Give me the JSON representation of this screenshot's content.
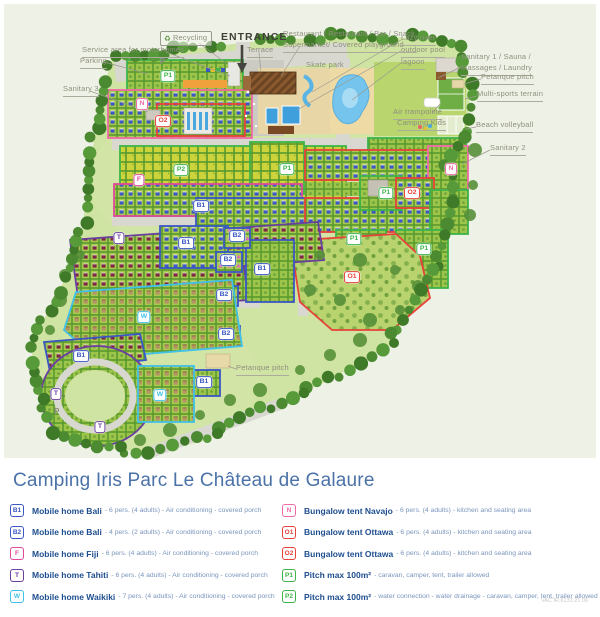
{
  "title": "Camping Iris Parc Le Château de Galaure",
  "note": "VAC IR.6133.21 06",
  "map": {
    "colors": {
      "blue": "#3a57c4",
      "magenta": "#e0489b",
      "purple": "#6a3fa0",
      "cyan": "#3fc1e8",
      "pink": "#f06aa8",
      "red": "#e8423a",
      "green": "#3db54a"
    },
    "labels": [
      {
        "t": "Recycling",
        "x": 160,
        "y": 31,
        "cls": "boxed",
        "icon": "recycle",
        "line": [
          199,
          43,
          226,
          63
        ]
      },
      {
        "t": "ENTRANCE",
        "x": 221,
        "y": 30,
        "cls": "entrance"
      },
      {
        "t": "Service area for motorhomes",
        "x": 82,
        "y": 45,
        "ul": 1,
        "line": [
          166,
          52,
          230,
          76
        ]
      },
      {
        "t": "Parking",
        "x": 80,
        "y": 56,
        "ul": 1,
        "line": [
          104,
          62,
          148,
          74
        ]
      },
      {
        "t": "Sanitary 3",
        "x": 63,
        "y": 84,
        "ul": 1,
        "line": [
          90,
          91,
          148,
          112
        ]
      },
      {
        "t": "Terrace",
        "x": 247,
        "y": 45,
        "ul": 1,
        "line": [
          259,
          52,
          261,
          72
        ]
      },
      {
        "t": "Restaurant / Restaurant / Bar / Snack,\nSupermarket/ Covered playground",
        "x": 283,
        "y": 29,
        "ul": 1,
        "line": [
          300,
          46,
          281,
          76
        ]
      },
      {
        "t": "Lazy river",
        "x": 401,
        "y": 33,
        "ul": 1,
        "line": [
          401,
          40,
          312,
          92
        ]
      },
      {
        "t": "outdoor pool",
        "x": 401,
        "y": 45,
        "ul": 1,
        "line": [
          401,
          51,
          297,
          110
        ]
      },
      {
        "t": "lagoon",
        "x": 401,
        "y": 57,
        "ul": 1,
        "line": [
          401,
          63,
          352,
          100
        ]
      },
      {
        "t": "Skate park",
        "x": 306,
        "y": 60
      },
      {
        "t": "Sanitary 1 / Sauna /\nMassages / Laundry",
        "x": 461,
        "y": 52,
        "ul": 1,
        "line": [
          461,
          67,
          438,
          78
        ]
      },
      {
        "t": "Petanque pitch",
        "x": 481,
        "y": 72,
        "ul": 1,
        "line": [
          481,
          79,
          464,
          84
        ]
      },
      {
        "t": "Multi-sports terrain",
        "x": 477,
        "y": 89,
        "ul": 1,
        "line": [
          477,
          96,
          465,
          99
        ]
      },
      {
        "t": "Air trampoline",
        "x": 393,
        "y": 107,
        "ul": 1,
        "line": [
          432,
          113,
          440,
          104
        ]
      },
      {
        "t": "Camping Kids",
        "x": 397,
        "y": 118,
        "ul": 1,
        "line": [
          424,
          125,
          423,
          129
        ]
      },
      {
        "t": "Beach volleyball",
        "x": 476,
        "y": 120,
        "ul": 1,
        "line": [
          476,
          127,
          466,
          129
        ]
      },
      {
        "t": "Sanitary 2",
        "x": 490,
        "y": 143,
        "ul": 1,
        "line": [
          490,
          150,
          462,
          164
        ]
      },
      {
        "t": "Petanque pitch",
        "x": 236,
        "y": 363,
        "ul": 1,
        "line": [
          236,
          369,
          228,
          366
        ]
      },
      {
        "t": "P",
        "x": 160,
        "y": 56,
        "cls": "roadmark"
      },
      {
        "t": "P",
        "x": 54,
        "y": 406,
        "cls": "roadmark"
      }
    ],
    "badges": [
      {
        "l": "P1",
        "x": 168,
        "y": 76,
        "c": "green"
      },
      {
        "l": "N",
        "x": 142,
        "y": 104,
        "c": "pink"
      },
      {
        "l": "O2",
        "x": 163,
        "y": 121,
        "c": "red"
      },
      {
        "l": "P2",
        "x": 181,
        "y": 170,
        "c": "green"
      },
      {
        "l": "F",
        "x": 139,
        "y": 180,
        "c": "magenta"
      },
      {
        "l": "P1",
        "x": 287,
        "y": 169,
        "c": "green"
      },
      {
        "l": "B1",
        "x": 201,
        "y": 206,
        "c": "blue"
      },
      {
        "l": "N",
        "x": 451,
        "y": 169,
        "c": "pink"
      },
      {
        "l": "P1",
        "x": 386,
        "y": 193,
        "c": "green"
      },
      {
        "l": "O2",
        "x": 412,
        "y": 193,
        "c": "red"
      },
      {
        "l": "T",
        "x": 119,
        "y": 238,
        "c": "purple"
      },
      {
        "l": "B2",
        "x": 237,
        "y": 236,
        "c": "blue"
      },
      {
        "l": "B1",
        "x": 186,
        "y": 243,
        "c": "blue"
      },
      {
        "l": "P1",
        "x": 354,
        "y": 239,
        "c": "green"
      },
      {
        "l": "P1",
        "x": 424,
        "y": 249,
        "c": "green"
      },
      {
        "l": "B2",
        "x": 228,
        "y": 260,
        "c": "blue"
      },
      {
        "l": "B1",
        "x": 262,
        "y": 269,
        "c": "blue"
      },
      {
        "l": "O1",
        "x": 352,
        "y": 277,
        "c": "red"
      },
      {
        "l": "B2",
        "x": 224,
        "y": 295,
        "c": "blue"
      },
      {
        "l": "W",
        "x": 144,
        "y": 317,
        "c": "cyan"
      },
      {
        "l": "B2",
        "x": 226,
        "y": 334,
        "c": "blue"
      },
      {
        "l": "B1",
        "x": 81,
        "y": 356,
        "c": "blue"
      },
      {
        "l": "B1",
        "x": 204,
        "y": 382,
        "c": "blue"
      },
      {
        "l": "T",
        "x": 56,
        "y": 394,
        "c": "purple"
      },
      {
        "l": "W",
        "x": 160,
        "y": 395,
        "c": "cyan"
      },
      {
        "l": "T",
        "x": 100,
        "y": 427,
        "c": "purple"
      }
    ]
  },
  "legend": {
    "left": [
      {
        "code": "B1",
        "color": "#3a57c4",
        "name": "Mobile home Bali",
        "details": "- 6 pers. (4 adults) - Air conditioning - covered porch"
      },
      {
        "code": "B2",
        "color": "#3a57c4",
        "name": "Mobile home Bali",
        "details": "- 4 pers. (2 adults) - Air conditioning - covered porch"
      },
      {
        "code": "F",
        "color": "#e0489b",
        "name": "Mobile home Fiji",
        "details": "- 6 pers. (4 adults) - Air conditioning - covered porch"
      },
      {
        "code": "T",
        "color": "#6a3fa0",
        "name": "Mobile home Tahiti",
        "details": "- 6 pers. (4 adults) - Air conditioning - covered porch"
      },
      {
        "code": "W",
        "color": "#3fc1e8",
        "name": "Mobile home Waikiki",
        "details": "- 7 pers. (4 adults) - Air conditioning - covered porch"
      }
    ],
    "right": [
      {
        "code": "N",
        "color": "#f06aa8",
        "name": "Bungalow tent Navajo",
        "details": "- 6 pers. (4 adults) - kitchen and seating area"
      },
      {
        "code": "O1",
        "color": "#e8423a",
        "name": "Bungalow tent Ottawa",
        "details": "- 6 pers. (4 adults) - kitchen and seating area"
      },
      {
        "code": "O2",
        "color": "#e8423a",
        "name": "Bungalow tent Ottawa",
        "details": "- 6 pers. (4 adults) - kitchen and seating area"
      },
      {
        "code": "P1",
        "color": "#3db54a",
        "name": "Pitch max 100m²",
        "details": "- caravan, camper, tent, trailer allowed"
      },
      {
        "code": "P2",
        "color": "#3db54a",
        "name": "Pitch max 100m²",
        "details": "- water connection - water drainage - caravan, camper, tent, trailer allowed"
      }
    ]
  }
}
